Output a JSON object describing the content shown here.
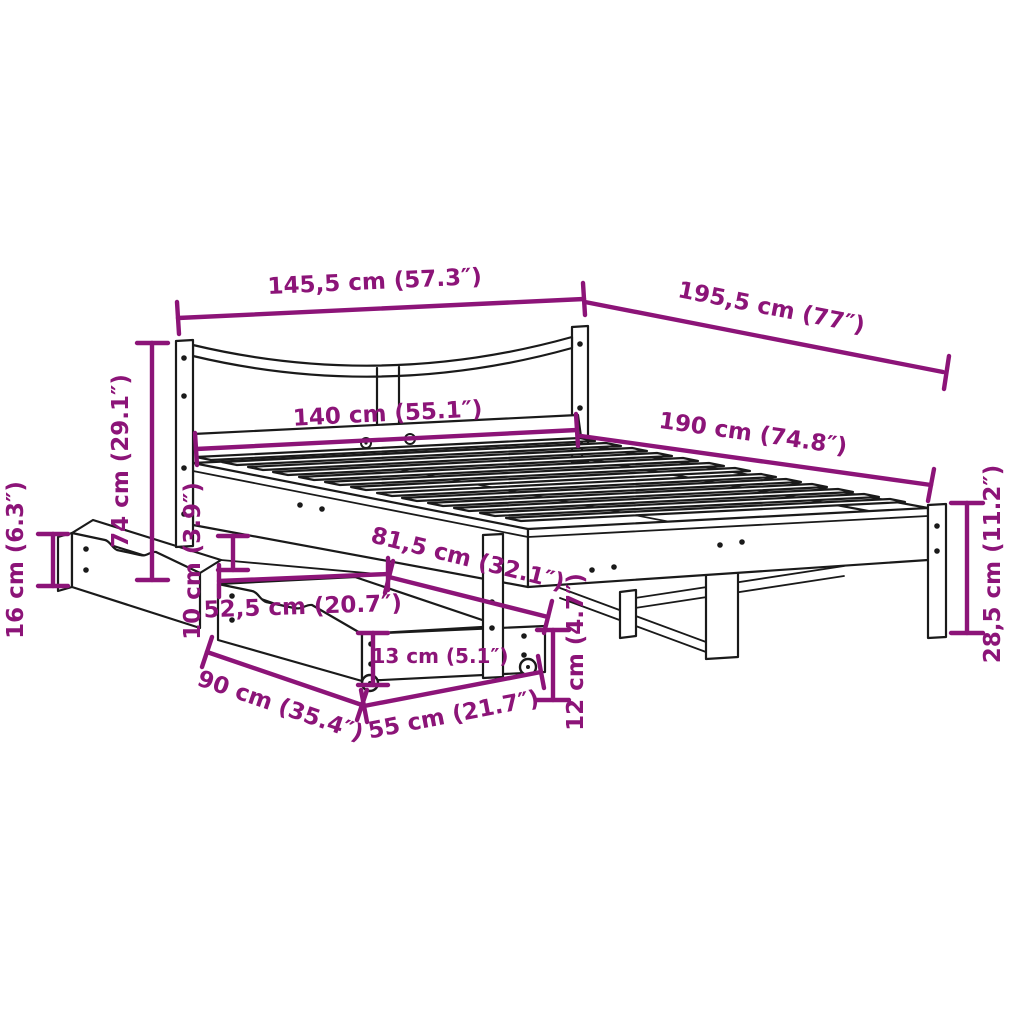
{
  "colors": {
    "dimension": "#8c1478",
    "line": "#1a1a1a",
    "background": "#ffffff"
  },
  "diagram": {
    "dimensions": [
      {
        "id": "headboard-outer-width",
        "label": "145,5 cm (57.3″)"
      },
      {
        "id": "frame-outer-length",
        "label": "195,5 cm (77″)"
      },
      {
        "id": "mattress-width",
        "label": "140 cm (55.1″)"
      },
      {
        "id": "mattress-length",
        "label": "190 cm (74.8″)"
      },
      {
        "id": "headboard-height",
        "label": "74 cm (29.1″)"
      },
      {
        "id": "drawer-side-height",
        "label": "16 cm (6.3″)"
      },
      {
        "id": "under-bed-clearance",
        "label": "10 cm (3.9″)"
      },
      {
        "id": "drawer-depth",
        "label": "52,5 cm (20.7″)"
      },
      {
        "id": "drawer-bay-length",
        "label": "81,5 cm (32.1″)"
      },
      {
        "id": "drawer-front-height",
        "label": "13 cm (5.1″)"
      },
      {
        "id": "drawer-width",
        "label": "90 cm (35.4″)"
      },
      {
        "id": "drawer-total-depth",
        "label": "55 cm (21.7″)"
      },
      {
        "id": "drawer-height-casters",
        "label": "12 cm (4.7″)"
      },
      {
        "id": "footboard-frame-height",
        "label": "28,5 cm (11.2″)"
      }
    ]
  }
}
